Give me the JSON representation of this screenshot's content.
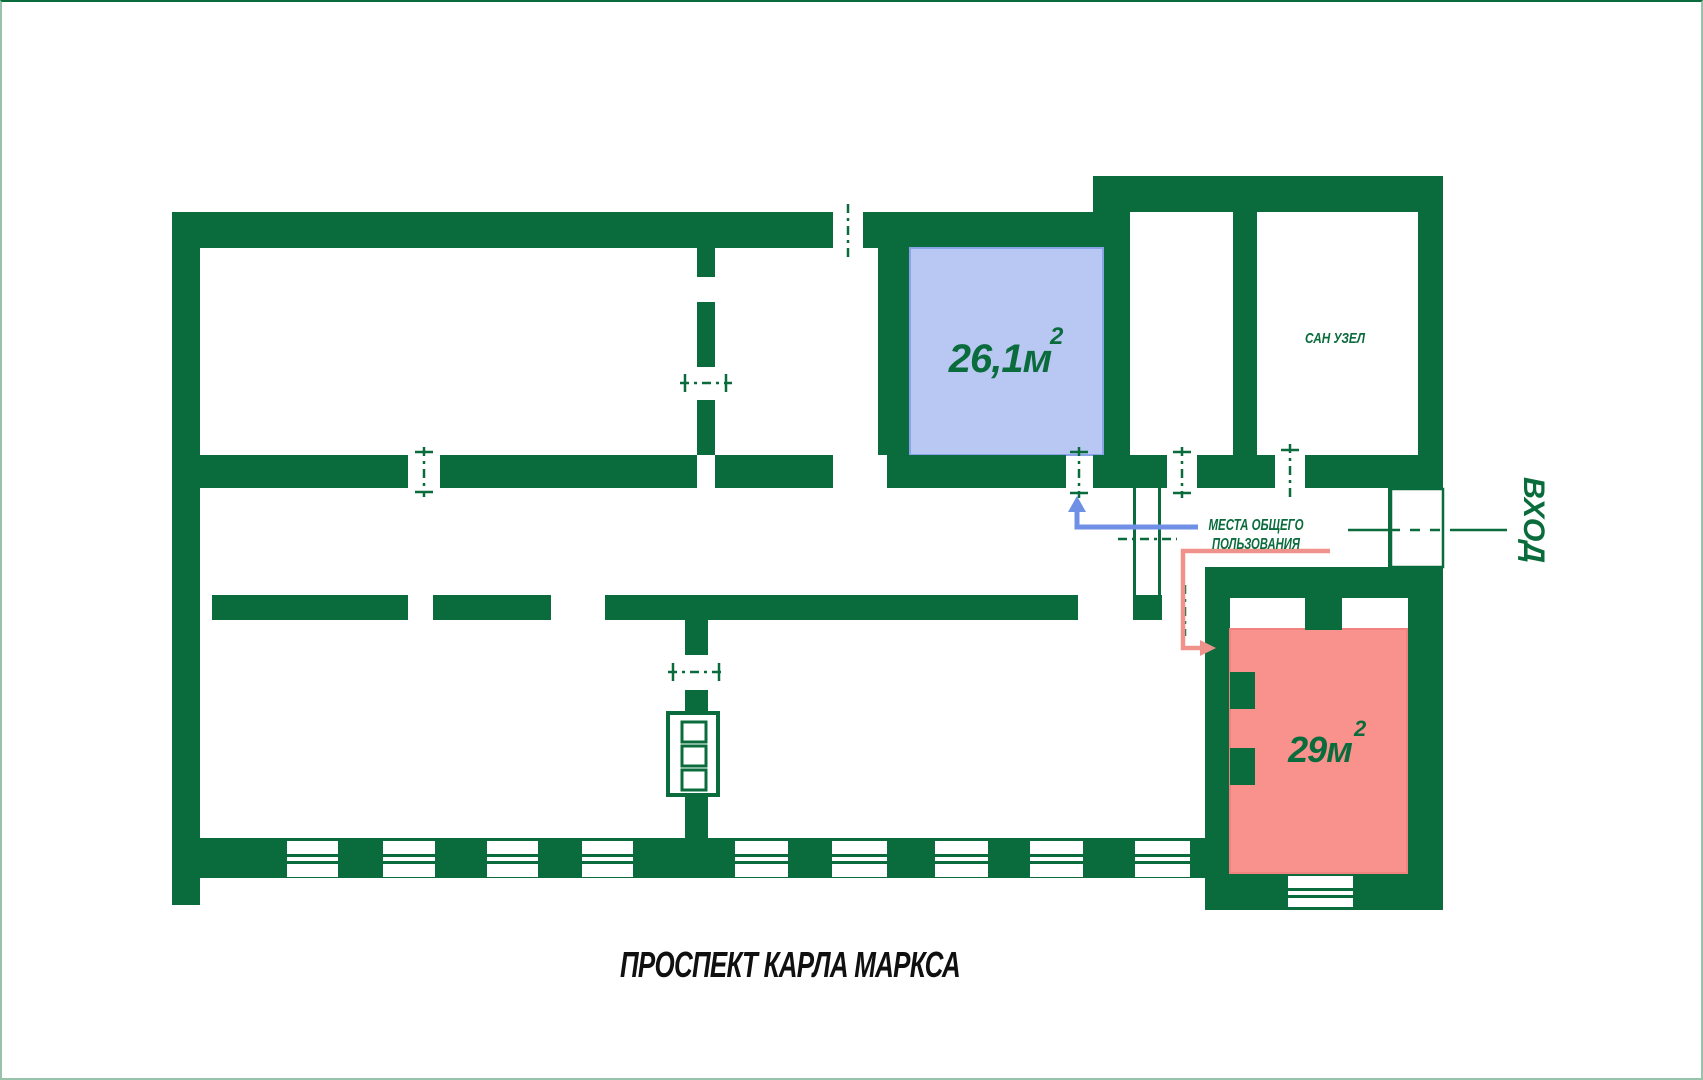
{
  "colors": {
    "green": "#0a6c3c",
    "blue-fill": "#b9c8f2",
    "blue-stroke": "#8ba3e8",
    "red-fill": "#f9918d",
    "red-stroke": "#f0837f",
    "arrow-blue": "#7090e5",
    "arrow-red": "#f0928c",
    "street": "#101010",
    "frame": "#97c3ac",
    "bg": "#ffffff"
  },
  "rooms": {
    "blue": {
      "area": "26,1м",
      "sup": "2"
    },
    "red": {
      "area": "29м",
      "sup": "2"
    },
    "san_uzel": {
      "label": "САН УЗЕЛ"
    }
  },
  "annotations": {
    "common_area_line1": "МЕСТА ОБЩЕГО",
    "common_area_line2": "ПОЛЬЗОВАНИЯ",
    "entrance": "ВХОД",
    "street": "ПРОСПЕКТ КАРЛА МАРКСА"
  }
}
